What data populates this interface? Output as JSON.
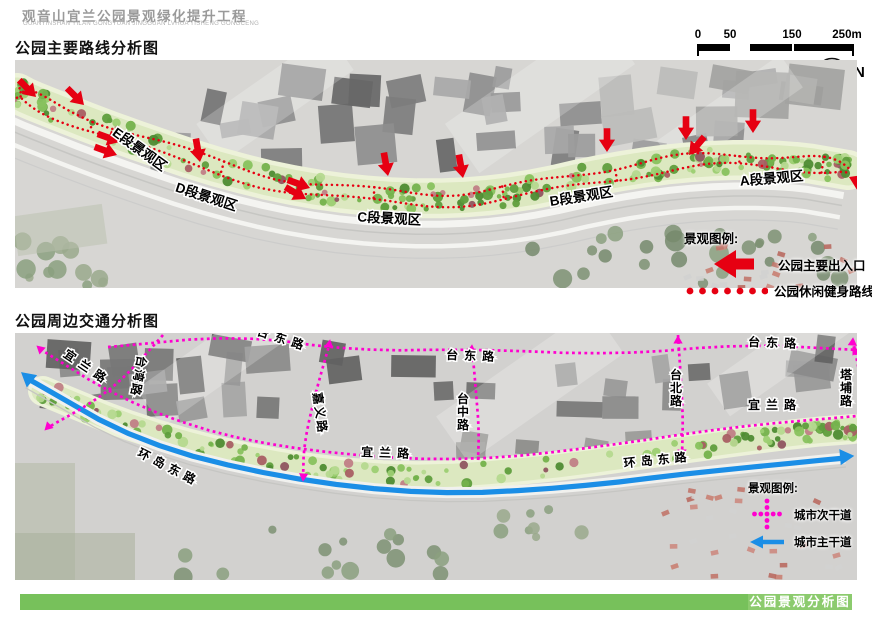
{
  "header": {
    "title": "观音山宜兰公园景观绿化提升工程",
    "subtitle": "GUANYINSHAN YILAN GONGYUAN JINGGUAN LVHUA TISHENG GONGCENG"
  },
  "sections": {
    "map1_title": "公园主要路线分析图",
    "map2_title": "公园周边交通分析图"
  },
  "scalebar": {
    "ticks": [
      "0",
      "50",
      "150",
      "250m"
    ]
  },
  "north_label": "N",
  "colors": {
    "accent_red": "#e60012",
    "magenta": "#ff00cf",
    "blue": "#1b8ee6",
    "green_bar": "#77c15b",
    "green_bar_box": "#8ccb6e",
    "band_fill": "#dce8c0",
    "band_edge": "#edf2d9"
  },
  "map1": {
    "band": [
      [
        2,
        33
      ],
      [
        15,
        40
      ],
      [
        105,
        75
      ],
      [
        215,
        112
      ],
      [
        315,
        133
      ],
      [
        415,
        140
      ],
      [
        505,
        133
      ],
      [
        595,
        112
      ],
      [
        685,
        100
      ],
      [
        775,
        100
      ],
      [
        833,
        110
      ]
    ],
    "zone_labels": [
      {
        "text": "E段景观区",
        "x": 122,
        "y": 93,
        "rot": 36
      },
      {
        "text": "D段景观区",
        "x": 190,
        "y": 141,
        "rot": 18
      },
      {
        "text": "C段景观区",
        "x": 374,
        "y": 163,
        "rot": 3
      },
      {
        "text": "B段景观区",
        "x": 567,
        "y": 141,
        "rot": -9
      },
      {
        "text": "A段景观区",
        "x": 757,
        "y": 123,
        "rot": -5
      }
    ],
    "entry_arrows": [
      {
        "x": 21,
        "y": 37,
        "rot": -135
      },
      {
        "x": 69,
        "y": 45,
        "rot": -135
      },
      {
        "x": 105,
        "y": 82,
        "rot": -160
      },
      {
        "x": 102,
        "y": 95,
        "rot": -160
      },
      {
        "x": 185,
        "y": 102,
        "rot": -100
      },
      {
        "x": 295,
        "y": 128,
        "rot": -160
      },
      {
        "x": 291,
        "y": 139,
        "rot": -150
      },
      {
        "x": 373,
        "y": 116,
        "rot": -100
      },
      {
        "x": 448,
        "y": 118,
        "rot": -100
      },
      {
        "x": 592,
        "y": 92,
        "rot": -90
      },
      {
        "x": 671,
        "y": 80,
        "rot": -90
      },
      {
        "x": 674,
        "y": 95,
        "rot": -50
      },
      {
        "x": 738,
        "y": 73,
        "rot": -90
      },
      {
        "x": 834,
        "y": 117,
        "rot": 25
      }
    ],
    "legend": {
      "title": "景观图例:",
      "entrance_label": "公园主要出入口",
      "route_label": "公园休闲健身路线"
    }
  },
  "map2": {
    "band": [
      [
        28,
        58
      ],
      [
        125,
        98
      ],
      [
        245,
        129
      ],
      [
        385,
        146
      ],
      [
        525,
        136
      ],
      [
        665,
        116
      ],
      [
        785,
        100
      ],
      [
        838,
        96
      ]
    ],
    "blue_road": [
      [
        15,
        47
      ],
      [
        125,
        110
      ],
      [
        265,
        145
      ],
      [
        415,
        162
      ],
      [
        555,
        155
      ],
      [
        685,
        139
      ],
      [
        830,
        125
      ]
    ],
    "roads": [
      {
        "name": "台东路",
        "pts": [
          [
            93,
            14
          ],
          [
            225,
            2
          ],
          [
            340,
            18
          ],
          [
            460,
            16
          ],
          [
            600,
            22
          ],
          [
            730,
            11
          ],
          [
            843,
            17
          ]
        ],
        "arrows": [
          {
            "x": 845,
            "y": 18,
            "rot": 90
          }
        ]
      },
      {
        "name": "宜兰路",
        "pts": [
          [
            25,
            16
          ],
          [
            105,
            66
          ],
          [
            205,
            103
          ],
          [
            325,
            122
          ],
          [
            455,
            128
          ],
          [
            585,
            114
          ],
          [
            715,
            94
          ],
          [
            842,
            83
          ]
        ],
        "arrows": [
          {
            "x": 22,
            "y": 13,
            "rot": -48
          }
        ]
      },
      {
        "name": "台湾路",
        "pts": [
          [
            148,
            2
          ],
          [
            112,
            42
          ],
          [
            80,
            68
          ],
          [
            32,
            95
          ]
        ],
        "arrows": [
          {
            "x": 30,
            "y": 97,
            "rot": -135
          }
        ]
      },
      {
        "name": "嘉义路",
        "pts": [
          [
            315,
            9
          ],
          [
            301,
            58
          ],
          [
            289,
            110
          ],
          [
            288,
            146
          ]
        ],
        "arrows": [
          {
            "x": 315,
            "y": 7,
            "rot": 10
          },
          {
            "x": 288,
            "y": 148,
            "rot": 185
          }
        ]
      },
      {
        "name": "台中路",
        "pts": [
          [
            457,
            14
          ],
          [
            461,
            58
          ],
          [
            464,
            98
          ],
          [
            463,
            127
          ]
        ],
        "arrows": [
          {
            "x": 457,
            "y": 12,
            "rot": 5
          }
        ]
      },
      {
        "name": "台北路",
        "pts": [
          [
            663,
            2
          ],
          [
            666,
            48
          ],
          [
            668,
            88
          ],
          [
            667,
            122
          ]
        ],
        "arrows": [
          {
            "x": 663,
            "y": 3,
            "rot": 0
          },
          {
            "x": 667,
            "y": 124,
            "rot": 180
          }
        ]
      },
      {
        "name": "塔埔路",
        "pts": [
          [
            838,
            7
          ],
          [
            846,
            48
          ],
          [
            850,
            84
          ],
          [
            851,
            119
          ]
        ],
        "arrows": [
          {
            "x": 838,
            "y": 5,
            "rot": 5
          },
          {
            "x": 851,
            "y": 121,
            "rot": 180
          }
        ]
      }
    ],
    "road_labels": [
      {
        "text": "台东路",
        "x": 267,
        "y": 10,
        "rot": 18,
        "ls": 6
      },
      {
        "text": "台东路",
        "x": 458,
        "y": 27,
        "rot": 2,
        "ls": 6
      },
      {
        "text": "台东路",
        "x": 760,
        "y": 14,
        "rot": 2,
        "ls": 6
      },
      {
        "text": "宜兰路",
        "x": 70,
        "y": 38,
        "rot": 34,
        "ls": 6
      },
      {
        "text": "宜兰路",
        "x": 373,
        "y": 124,
        "rot": 2,
        "ls": 6
      },
      {
        "text": "宜兰路",
        "x": 760,
        "y": 76,
        "rot": 0,
        "ls": 6
      },
      {
        "text": "环岛东路",
        "x": 152,
        "y": 138,
        "rot": 27,
        "ls": 5
      },
      {
        "text": "环岛东路",
        "x": 643,
        "y": 131,
        "rot": -6,
        "ls": 5
      },
      {
        "text": "台湾路",
        "x": 123,
        "y": 22,
        "rot": 100,
        "ls": 2,
        "anchor": "start"
      },
      {
        "text": "嘉义路",
        "x": 298,
        "y": 60,
        "rot": 82,
        "ls": 2,
        "anchor": "start"
      },
      {
        "text": "台中路",
        "x": 448,
        "y": 70,
        "mode": "v"
      },
      {
        "text": "台北路",
        "x": 661,
        "y": 46,
        "mode": "v"
      },
      {
        "text": "塔埔路",
        "x": 831,
        "y": 46,
        "mode": "v"
      }
    ],
    "legend": {
      "title": "景观图例:",
      "secondary_label": "城市次干道",
      "primary_label": "城市主干道"
    }
  },
  "footer": {
    "title": "公园景观分析图"
  }
}
